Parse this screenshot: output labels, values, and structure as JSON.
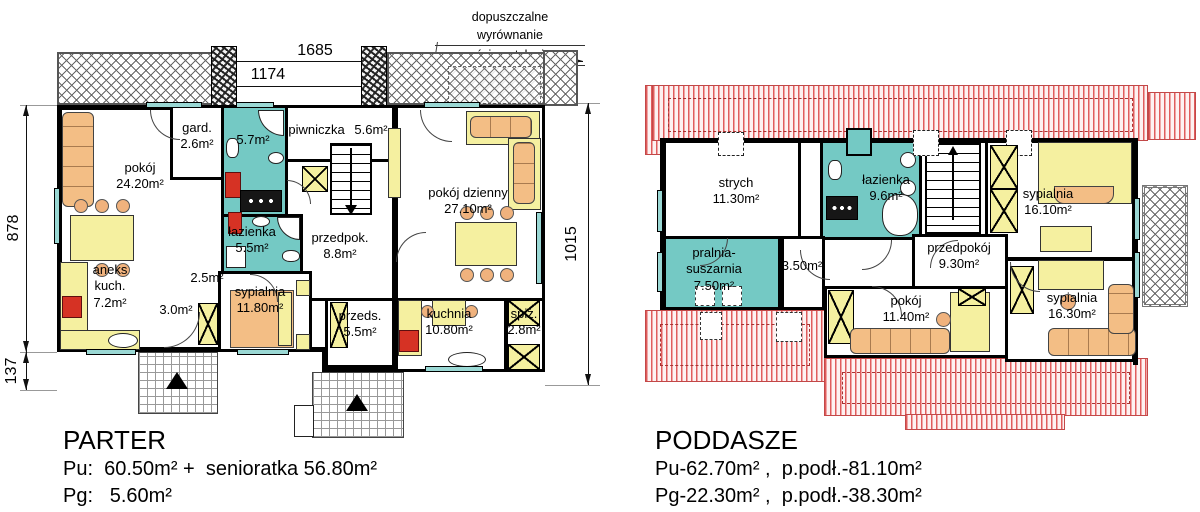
{
  "note": {
    "line1": "dopuszczalne wyrównanie",
    "line2": "ściany tylnej"
  },
  "dimensions": {
    "top_total": "1685",
    "top_left": "1174",
    "top_right": "511",
    "left_height": "878",
    "left_offset": "137",
    "right_height": "1015"
  },
  "colors": {
    "bath_teal": "#74c9c4",
    "roof_red": "#e05c5c",
    "furniture_yellow": "#f5f0a0",
    "furniture_orange": "#f3be85",
    "accent_red": "#d63224",
    "window_teal": "#9ad8d4",
    "wall": "#000000"
  },
  "parter": {
    "rooms": [
      {
        "name": "pokój",
        "area": "24.20m²"
      },
      {
        "name": "gard.",
        "area": "2.6m²"
      },
      {
        "name": "",
        "area": "5.7m²"
      },
      {
        "name": "piwniczka",
        "area": "5.6m²"
      },
      {
        "name": "pokój dzienny",
        "area": "27.10m²"
      },
      {
        "name": "łazienka",
        "area": "5.5m²"
      },
      {
        "name": "przedpok.",
        "area": "8.8m²"
      },
      {
        "name": "aneks kuch.",
        "area": "7.2m²"
      },
      {
        "name": "",
        "area": "2.5m²"
      },
      {
        "name": "",
        "area": "3.0m²"
      },
      {
        "name": "sypialnia",
        "area": "11.80m²"
      },
      {
        "name": "przeds.",
        "area": "5.5m²"
      },
      {
        "name": "kuchnia",
        "area": "10.80m²"
      },
      {
        "name": "spiż.",
        "area": "2.8m²"
      }
    ],
    "footer": {
      "title": "PARTER",
      "line1": "Pu:  60.50m² +  senioratka 56.80m²",
      "line2": "Pg:   5.60m²"
    }
  },
  "poddasze": {
    "rooms": [
      {
        "name": "strych",
        "area": "11.30m²"
      },
      {
        "name": "łazienka",
        "area": "9.6m²"
      },
      {
        "name": "sypialnia",
        "area": "16.10m²"
      },
      {
        "name": "pralnia- suszarnia",
        "area": "7.50m²"
      },
      {
        "name": "",
        "area": "3.50m²"
      },
      {
        "name": "przedpokój",
        "area": "9.30m²"
      },
      {
        "name": "pokój",
        "area": "11.40m²"
      },
      {
        "name": "sypialnia",
        "area": "16.30m²"
      }
    ],
    "footer": {
      "title": "PODDASZE",
      "line1": "Pu-62.70m² ,  p.podł.-81.10m²",
      "line2": "Pg-22.30m² ,  p.podł.-38.30m²"
    }
  }
}
